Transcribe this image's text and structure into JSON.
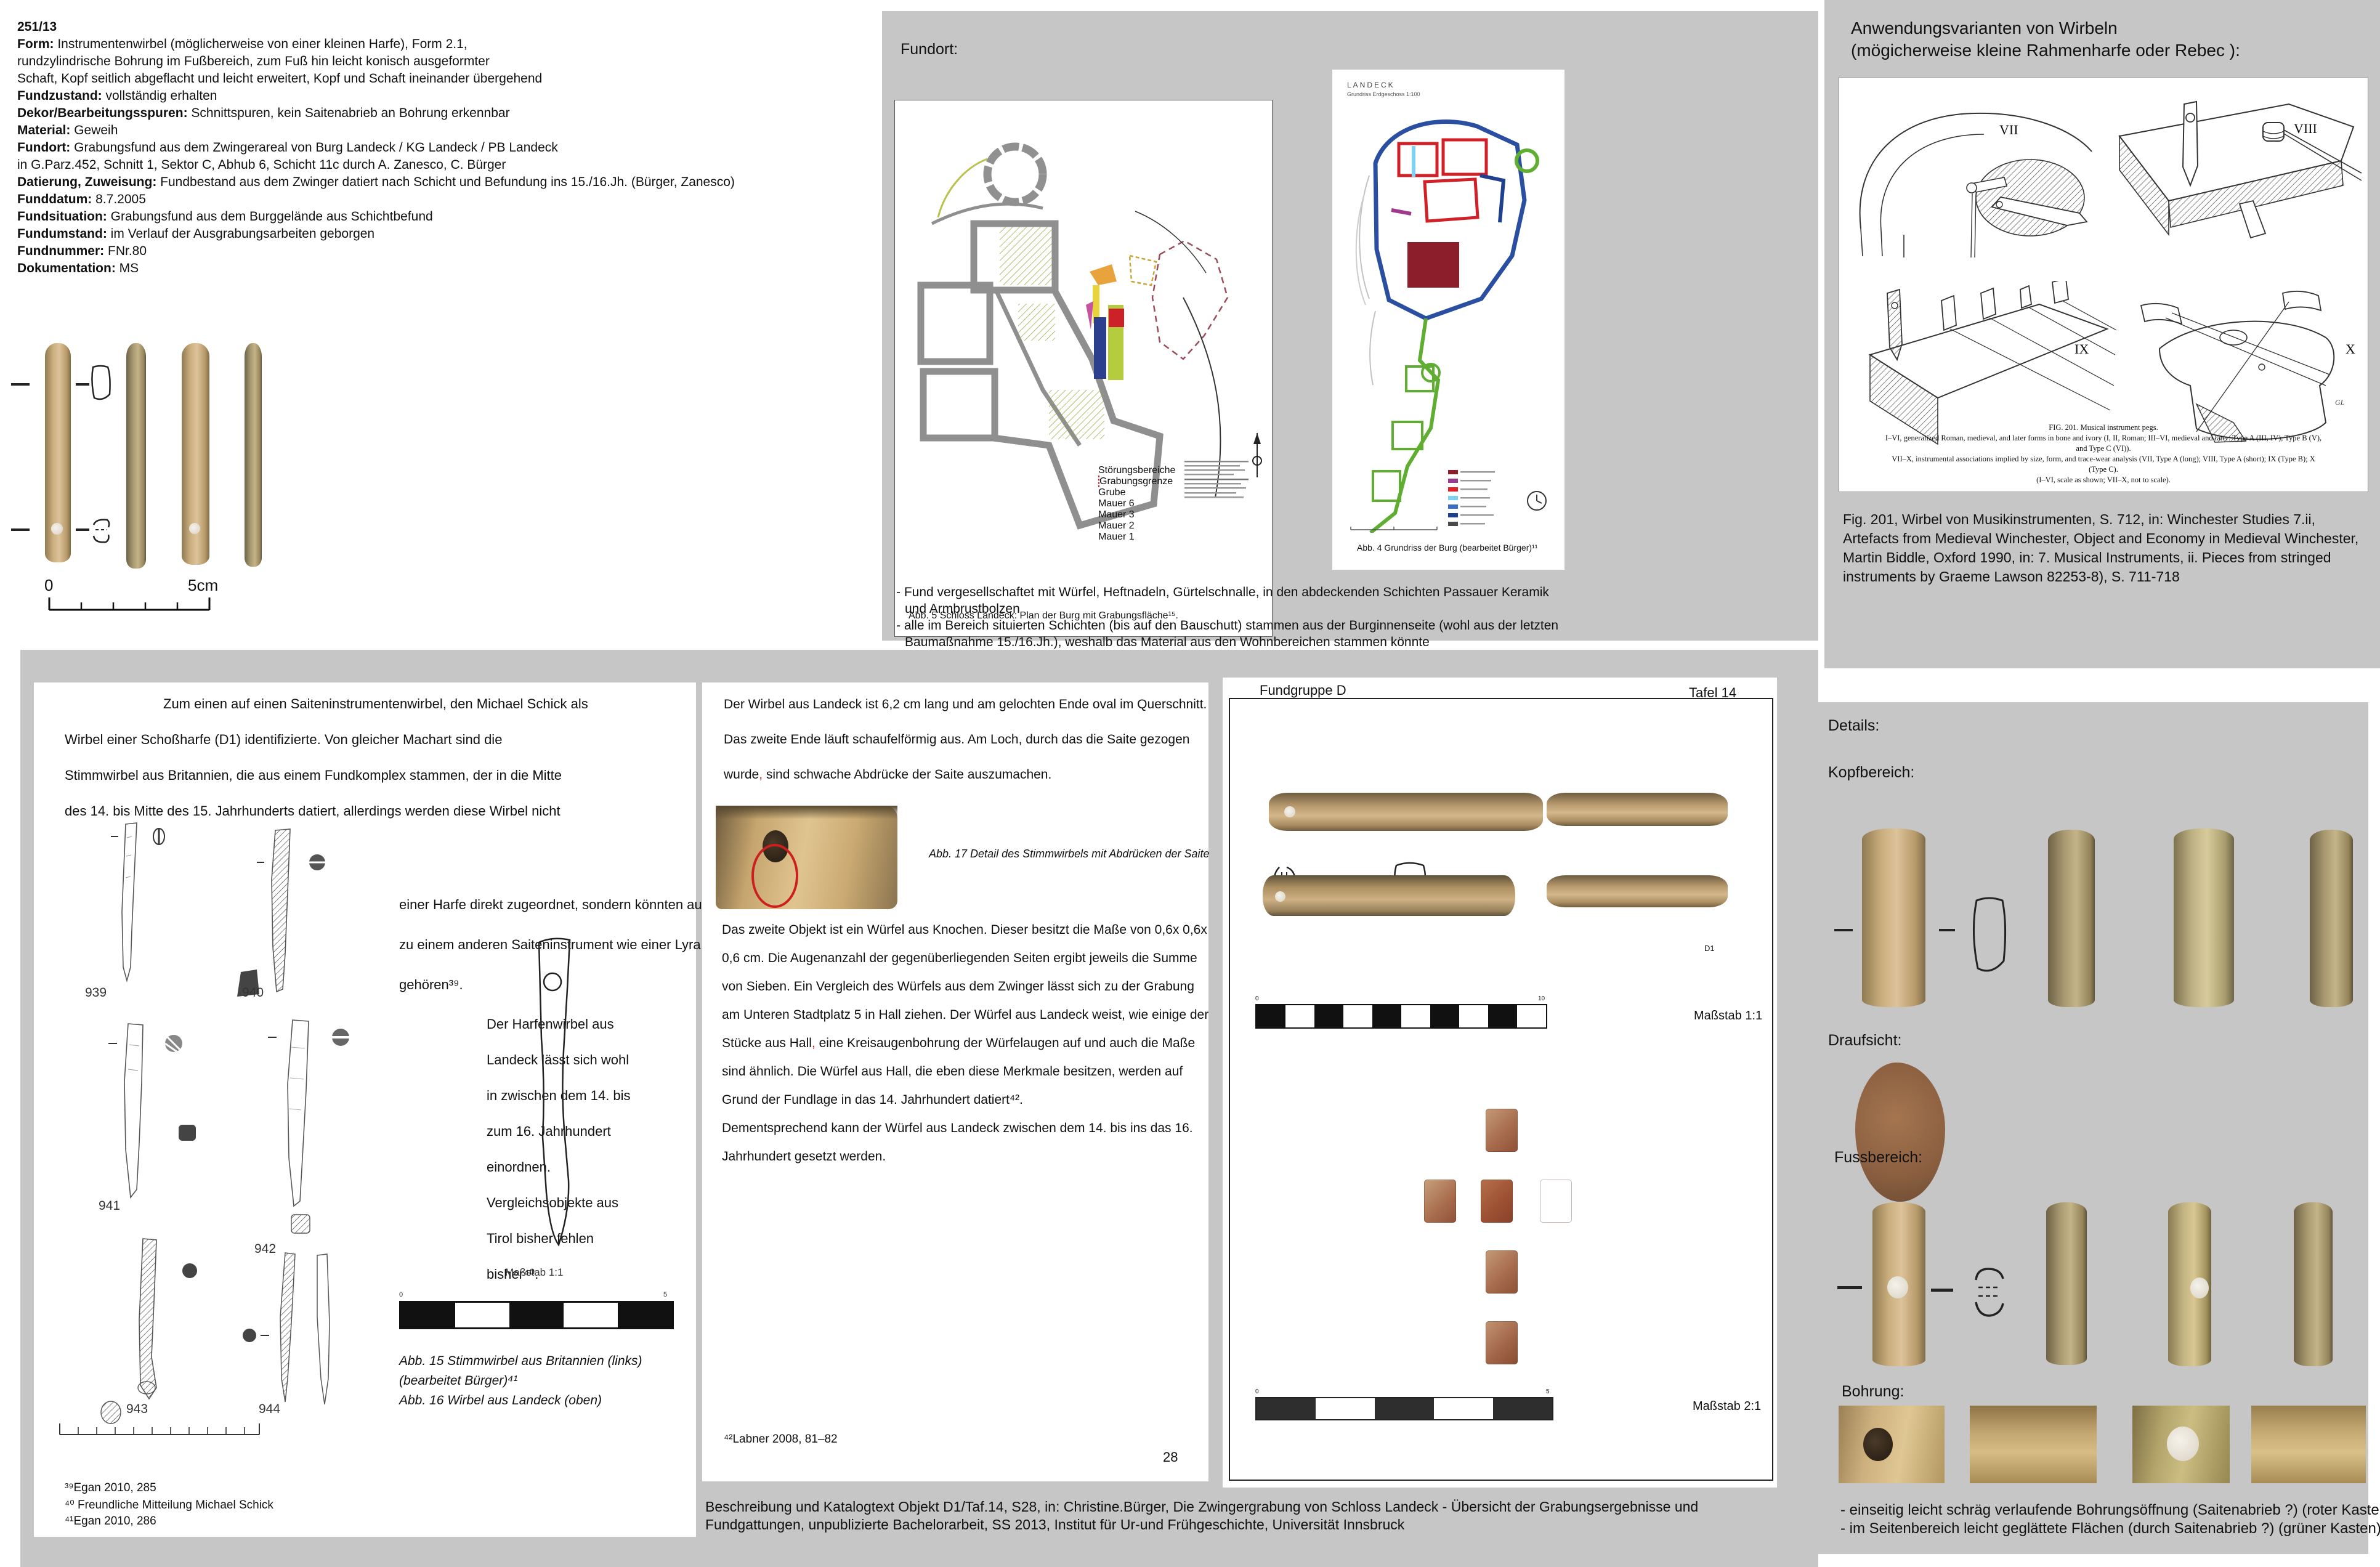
{
  "catalog": {
    "lines": [
      {
        "b": "251/13",
        "t": ""
      },
      {
        "b": "Form:",
        "t": " Instrumentenwirbel (möglicherweise von einer kleinen Harfe), Form 2.1,"
      },
      {
        "b": "",
        "t": "rundzylindrische Bohrung im Fußbereich, zum Fuß hin leicht konisch ausgeformter"
      },
      {
        "b": "",
        "t": "Schaft, Kopf seitlich abgeflacht und leicht erweitert, Kopf und Schaft ineinander übergehend"
      },
      {
        "b": "Fundzustand:",
        "t": " vollständig erhalten"
      },
      {
        "b": "Dekor/Bearbeitungsspuren:",
        "t": " Schnittspuren, kein Saitenabrieb an Bohrung erkennbar"
      },
      {
        "b": "Material:",
        "t": " Geweih"
      },
      {
        "b": "Fundort:",
        "t": " Grabungsfund aus dem Zwingerareal von Burg Landeck /  KG Landeck / PB Landeck"
      },
      {
        "b": "",
        "t": "in G.Parz.452, Schnitt 1, Sektor C, Abhub 6, Schicht 11c durch A. Zanesco, C. Bürger"
      },
      {
        "b": "Datierung, Zuweisung:",
        "t": " Fundbestand aus dem Zwinger datiert nach Schicht und Befundung  ins 15./16.Jh. (Bürger, Zanesco)"
      },
      {
        "b": "Funddatum:",
        "t": " 8.7.2005"
      },
      {
        "b": "Fundsituation:",
        "t": " Grabungsfund aus dem Burggelände aus Schichtbefund"
      },
      {
        "b": "Fundumstand:",
        "t": " im Verlauf der Ausgrabungsarbeiten geborgen"
      },
      {
        "b": "Fundnummer:",
        "t": " FNr.80"
      },
      {
        "b": "Dokumentation:",
        "t": " MS"
      }
    ]
  },
  "object_photos": {
    "scale_start": "0",
    "scale_end": "5cm"
  },
  "fundort": {
    "label": "Fundort:",
    "abb5_caption": "Abb. 5 Schloss Landeck: Plan der Burg mit Grabungsfläche¹⁵.",
    "legend": [
      "Störungsbereiche",
      "Grabungsgrenze",
      "Grube",
      "Mauer 6",
      "Mauer 3",
      "Mauer 2",
      "Mauer 1"
    ],
    "abb4_title": "LANDECK",
    "abb4_subtitle": "Grundriss Erdgeschoss 1:100",
    "abb4_caption": "Abb. 4 Grundriss der Burg (bearbeitet Bürger)¹¹",
    "bullets": [
      "- Fund vergesellschaftet mit Würfel, Heftnadeln, Gürtelschnalle, in den abdeckenden Schichten Passauer Keramik",
      "und Armbrustbolzen",
      "- alle im Bereich situierten Schichten (bis auf den Bauschutt) stammen aus der Burginnenseite (wohl aus der letzten",
      "Baumaßnahme 15./16.Jh.), weshalb das Material aus den Wohnbereichen stammen könnte"
    ]
  },
  "anwendung": {
    "title1": "Anwendungsvarianten von Wirbeln",
    "title2": "(mögicherweise kleine Rahmenharfe oder Rebec ):",
    "num_vii": "VII",
    "num_viii": "VIII",
    "num_ix": "IX",
    "num_x": "X",
    "sig": "GL",
    "fig_caption": [
      "FIG. 201.  Musical instrument pegs.",
      "I–VI, generalized Roman, medieval, and later forms in bone and ivory (I, II, Roman; III–VI, medieval and later: Type A (III, IV), Type B (V),",
      "and Type C (VI)).",
      "VII–X, instrumental associations implied by size, form, and trace-wear analysis (VII, Type A (long); VIII, Type A (short); IX (Type B); X",
      "(Type C).",
      "(I–VI, scale as shown; VII–X, not to scale)."
    ],
    "credit": [
      "Fig. 201, Wirbel von Musikinstrumenten, S. 712, in: Winchester Studies 7.ii,",
      "Artefacts from Medieval Winchester, Object and Economy in Medieval Winchester,",
      "Martin Biddle, Oxford 1990, in: 7. Musical Instruments, ii. Pieces from stringed",
      "instruments by Graeme Lawson 82253-8), S. 711-718"
    ]
  },
  "left_panel": {
    "p1": [
      "Zum einen auf einen Saiteninstrumentenwirbel, den Michael Schick als",
      "Wirbel einer Schoßharfe (D1) identifizierte. Von gleicher Machart sind die",
      "Stimmwirbel aus Britannien, die aus einem Fundkomplex stammen, der in die Mitte",
      "des 14. bis Mitte des 15. Jahrhunderts datiert, allerdings werden diese Wirbel nicht"
    ],
    "p2": [
      "einer Harfe direkt zugeordnet, sondern könnten auch",
      "zu einem anderen Saiteninstrument wie einer Lyra",
      "gehören³⁹."
    ],
    "p3": [
      "Der Harfenwirbel aus",
      "Landeck lässt sich wohl",
      "in zwischen dem 14. bis",
      "zum 16. Jahrhundert",
      "einordnen.",
      "Vergleichsobjekte aus",
      "Tirol bisher fehlen",
      "bisher⁴⁰."
    ],
    "labels": [
      "939",
      "940",
      "941",
      "942",
      "943",
      "944"
    ],
    "masstab": "Maßstab 1:1",
    "bar0": "0",
    "bar5": "5",
    "captions": [
      "Abb. 15 Stimmwirbel aus Britannien (links)",
      "(bearbeitet Bürger)⁴¹",
      "Abb. 16 Wirbel aus Landeck (oben)"
    ],
    "footnotes": [
      "³⁹Egan 2010, 285",
      "⁴⁰ Freundliche Mitteilung Michael Schick",
      "⁴¹Egan 2010, 286"
    ]
  },
  "mid_panel": {
    "p1a": "Der Wirbel aus Landeck ist 6,2 cm lang und am gelochten Ende oval im Querschnitt.",
    "p1b": "Das zweite Ende läuft schaufelförmig aus. Am Loch, durch das die Saite gezogen",
    "p1c_pre": "wurde",
    "p1c_comma": ",",
    "p1c_post": " sind schwache Abdrücke der Saite auszumachen.",
    "caption17": "Abb. 17 Detail des Stimmwirbels mit Abdrücken der Saite",
    "p2l1": "Das zweite Objekt ist ein Würfel aus Knochen. Dieser besitzt die Maße von 0,6x 0,6x",
    "p2l2": "0,6 cm. Die Augenanzahl der gegenüberliegenden Seiten ergibt jeweils die Summe",
    "p2l3": "von Sieben. Ein Vergleich des Würfels aus dem Zwinger lässt sich zu der Grabung",
    "p2l4": "am Unteren Stadtplatz 5 in Hall ziehen. Der Würfel aus Landeck weist, wie einige der",
    "p2l5_pre": "Stücke aus Hall",
    "p2l5_comma": ",",
    "p2l5_post": " eine Kreisaugenbohrung der Würfelaugen auf und auch die Maße",
    "p2l6": "sind ähnlich. Die Würfel aus Hall, die eben diese Merkmale besitzen, werden auf",
    "p2l7": "Grund der Fundlage in das 14. Jahrhundert datiert⁴².",
    "p2l8": "Dementsprechend kann der Würfel aus Landeck zwischen dem 14. bis ins das 16.",
    "p2l9": "Jahrhundert gesetzt werden.",
    "footnote": "⁴²Labner 2008, 81–82",
    "page_no": "28"
  },
  "tafel": {
    "header_left": "Fundgruppe D",
    "header_right": "Tafel 14",
    "d1": "D1",
    "m11": "Maßstab 1:1",
    "m21": "Maßstab 2:1",
    "bar1_0": "0",
    "bar1_10": "10",
    "bar2_0": "0",
    "bar2_5": "5"
  },
  "details": {
    "title": "Details:",
    "kopf": "Kopfbereich:",
    "drauf": "Draufsicht:",
    "fuss": "Fussbereich:",
    "bohrung": "Bohrung:",
    "notes": [
      "- einseitig leicht schräg verlaufende Bohrungsöffnung (Saitenabrieb ?) (roter Kasten)",
      "- im Seitenbereich leicht geglättete Flächen (durch Saitenabrieb ?) (grüner Kasten)"
    ]
  },
  "bottom_caption": [
    "Beschreibung und Katalogtext Objekt D1/Taf.14, S28, in: Christine.Bürger, Die Zwingergrabung von Schloss Landeck - Übersicht der Grabungsergebnisse und",
    "Fundgattungen, unpublizierte Bachelorarbeit, SS 2013, Institut für Ur-und Frühgeschichte, Universität Innsbruck"
  ],
  "colors": {
    "annotation_red": "#d42020",
    "annotation_green": "#2fbf3a",
    "panel_gray": "#c6c6c6",
    "bone": "#c9ad7c",
    "dice": "#a86a4c"
  }
}
